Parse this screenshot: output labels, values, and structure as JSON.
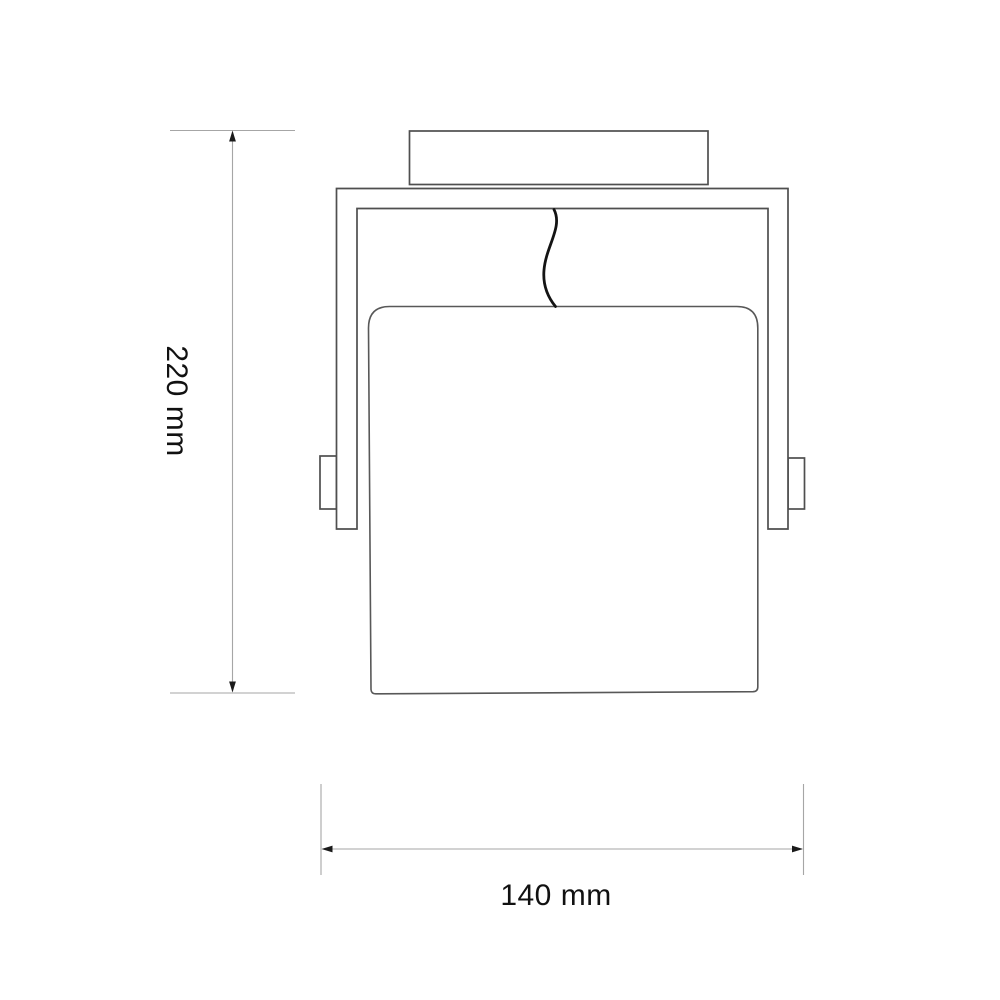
{
  "page": {
    "type": "technical dimension drawing",
    "subject": "wall lamp / spotlight fixture, front elevation view",
    "background_color": "#ffffff"
  },
  "drawing": {
    "outline_color": "#4f4f4f",
    "shade_outline_color": "#585858",
    "cable_color": "#141414",
    "components": {
      "canopy": "rectangular ceiling mount plate at top",
      "bracket": "inverted U-shaped mounting yoke",
      "knob_left": "pivot knob on outside of left arm",
      "knob_right": "pivot knob on outside of right arm",
      "shade": "large rounded-top square lamp shade",
      "cable": "S-curved power cable from canopy to shade"
    }
  },
  "dimensions": {
    "line_color": "#a6a6a6",
    "arrow_color": "#1a1a1a",
    "text_color": "#111111",
    "height": {
      "label": "220 mm",
      "value": 220,
      "unit": "mm",
      "orientation": "vertical"
    },
    "width": {
      "label": "140 mm",
      "value": 140,
      "unit": "mm",
      "orientation": "horizontal"
    }
  }
}
